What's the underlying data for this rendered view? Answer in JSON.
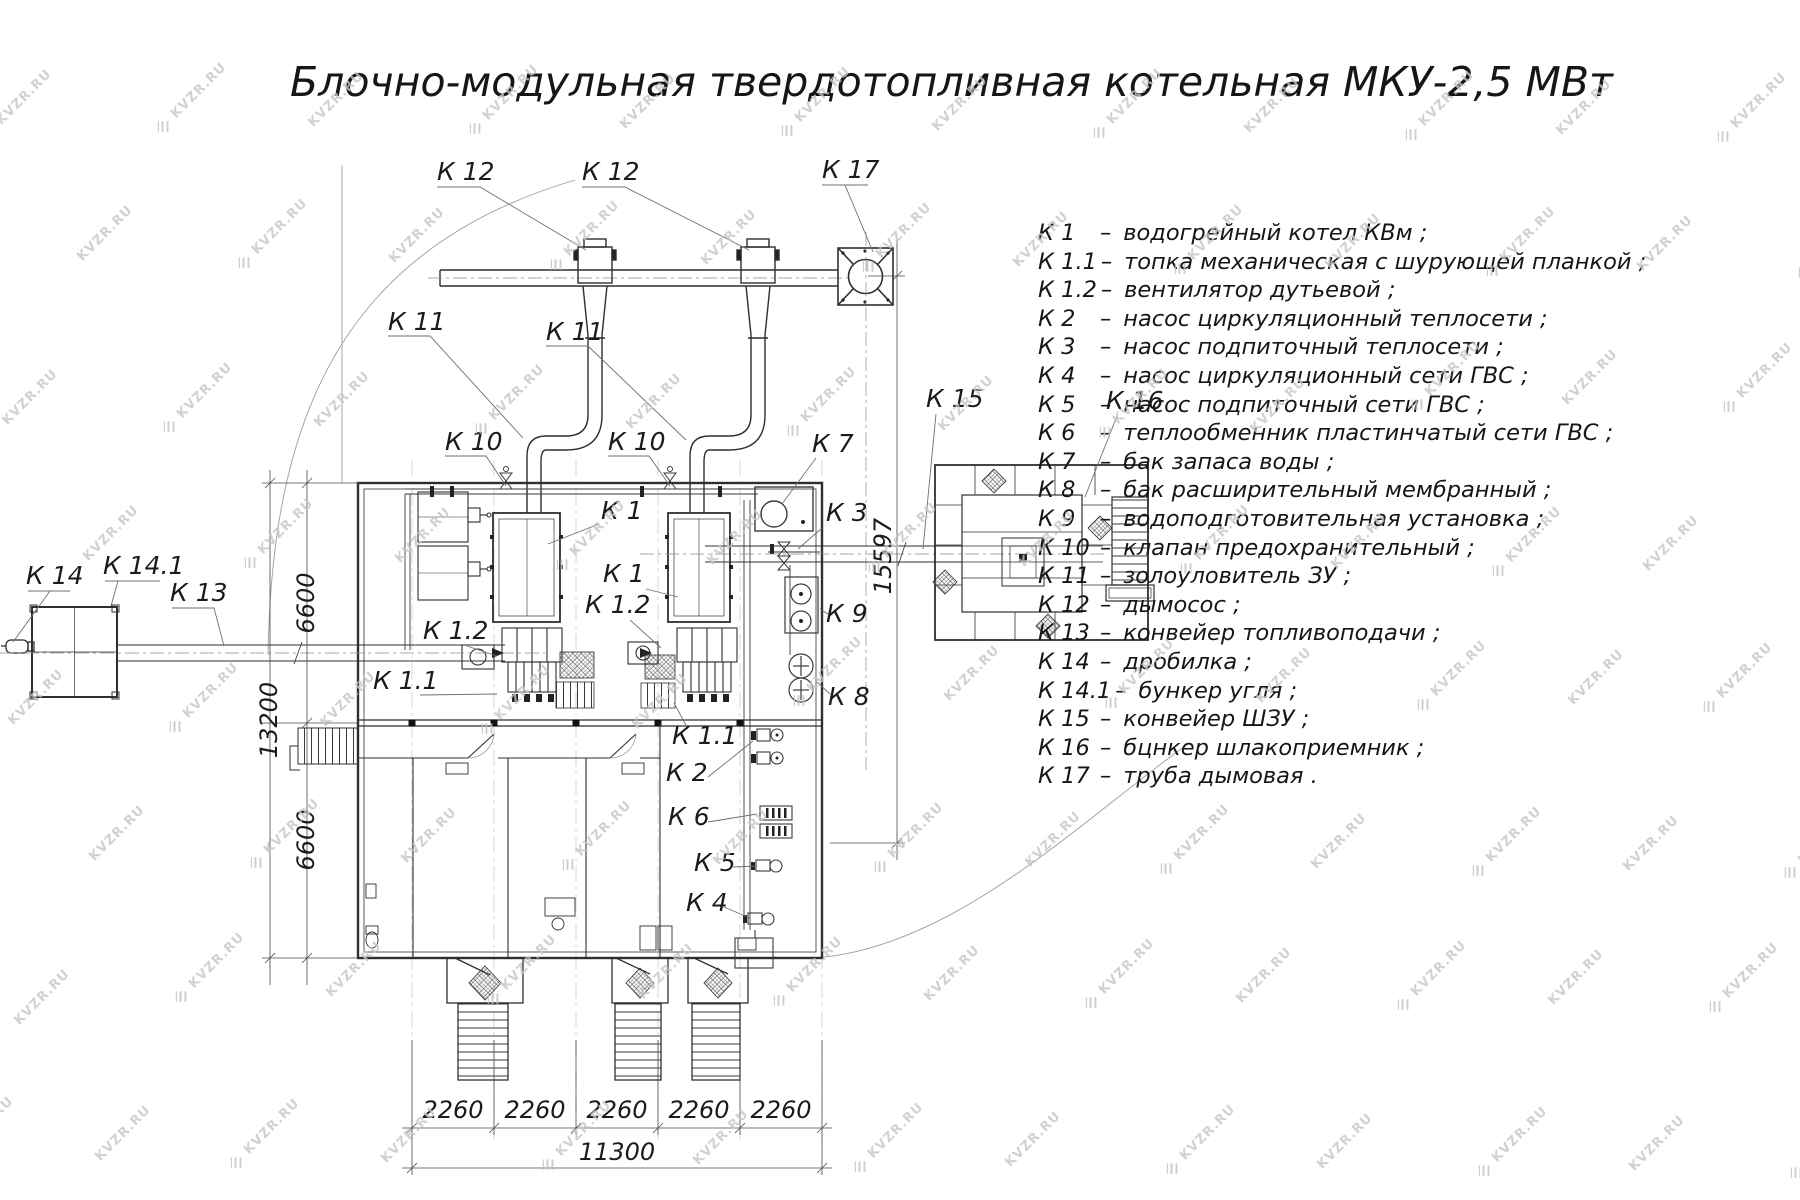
{
  "watermark": {
    "text": "KVZR.RU"
  },
  "title": {
    "text": "Блочно-модульная твердотопливная котельная МКУ-2,5 МВт"
  },
  "legend": {
    "separator": "–",
    "items": [
      {
        "code": "К 1",
        "desc": "водогрейный котел КВм ;"
      },
      {
        "code": "К 1.1",
        "desc": "топка механическая с шурующей планкой ;"
      },
      {
        "code": "К 1.2",
        "desc": "вентилятор дутьевой ;"
      },
      {
        "code": "К 2",
        "desc": "насос циркуляционный теплосети ;"
      },
      {
        "code": "К 3",
        "desc": "насос подпиточный теплосети ;"
      },
      {
        "code": "К 4",
        "desc": "насос циркуляционный сети ГВС ;"
      },
      {
        "code": "К 5",
        "desc": "насос подпиточный сети ГВС ;"
      },
      {
        "code": "К 6",
        "desc": "теплообменник пластинчатый сети ГВС ;"
      },
      {
        "code": "К 7",
        "desc": "бак запаса воды ;"
      },
      {
        "code": "К 8",
        "desc": "бак расширительный мембранный ;"
      },
      {
        "code": "К 9",
        "desc": "водоподготовительная установка ;"
      },
      {
        "code": "К 10",
        "desc": "клапан предохранительный ;"
      },
      {
        "code": "К 11",
        "desc": "золоуловитель ЗУ ;"
      },
      {
        "code": "К 12",
        "desc": "дымосос ;"
      },
      {
        "code": "К 13",
        "desc": "конвейер топливоподачи ;"
      },
      {
        "code": "К 14",
        "desc": "дробилка ;"
      },
      {
        "code": "К 14.1",
        "desc": "бункер угля ;"
      },
      {
        "code": "К 15",
        "desc": "конвейер ШЗУ ;"
      },
      {
        "code": "К 16",
        "desc": "бцнкер шлакоприемник ;"
      },
      {
        "code": "К 17",
        "desc": "труба дымовая ."
      }
    ]
  },
  "callouts": [
    {
      "text": "К 12"
    },
    {
      "text": "К 12"
    },
    {
      "text": "К 17"
    },
    {
      "text": "К 11"
    },
    {
      "text": "К 11"
    },
    {
      "text": "К 10"
    },
    {
      "text": "К 10"
    },
    {
      "text": "К 7"
    },
    {
      "text": "К 1"
    },
    {
      "text": "К 1"
    },
    {
      "text": "К 3"
    },
    {
      "text": "К 1.2"
    },
    {
      "text": "К 1.2"
    },
    {
      "text": "К 1.1"
    },
    {
      "text": "К 1.1"
    },
    {
      "text": "К 2"
    },
    {
      "text": "К 6"
    },
    {
      "text": "К 5"
    },
    {
      "text": "К 4"
    },
    {
      "text": "К 13"
    },
    {
      "text": "К 14"
    },
    {
      "text": "К 14.1"
    },
    {
      "text": "К 15"
    },
    {
      "text": "К 16"
    },
    {
      "text": "К 9"
    },
    {
      "text": "К 8"
    }
  ],
  "dimensions": {
    "left_top": "6600",
    "left_total": "13200",
    "left_bottom": "6600",
    "bottom_segments": [
      "2260",
      "2260",
      "2260",
      "2260",
      "2260"
    ],
    "bottom_total": "11300",
    "right_height": "15597"
  }
}
